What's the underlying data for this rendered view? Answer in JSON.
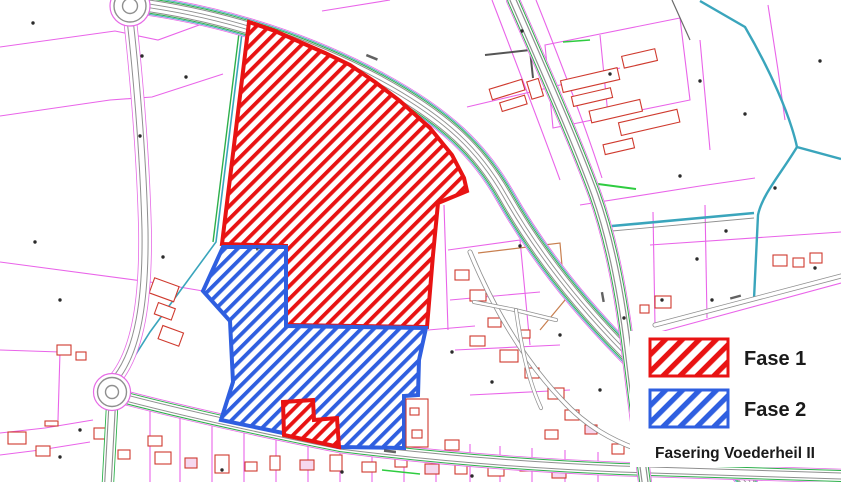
{
  "legend": {
    "items": [
      {
        "label": "Fase 1",
        "color": "#e81313",
        "pattern": "red-diagonal-hatch"
      },
      {
        "label": "Fase 2",
        "color": "#2f5fe0",
        "pattern": "blue-diagonal-hatch"
      }
    ],
    "caption": "Fasering Voederheil II"
  },
  "map": {
    "type": "cadastral-phasing-map",
    "areas": [
      {
        "name": "Fase 1",
        "style": "red-diagonal-hatch",
        "location": "large polygon upper-centre plus small parcel at bottom-centre"
      },
      {
        "name": "Fase 2",
        "style": "blue-diagonal-hatch",
        "location": "polygon below and left of Fase 1"
      }
    ],
    "colors": {
      "fase1": "#e81313",
      "fase2": "#2f5fe0",
      "parcel_lines": "#e964e9",
      "buildings": "#cf3a2e",
      "roads": "#8f8f8f",
      "road_edge_magenta": "#e66ae6",
      "green_edges": "#2db04b",
      "water_teal": "#3aa5bc",
      "background": "#ffffff"
    }
  }
}
